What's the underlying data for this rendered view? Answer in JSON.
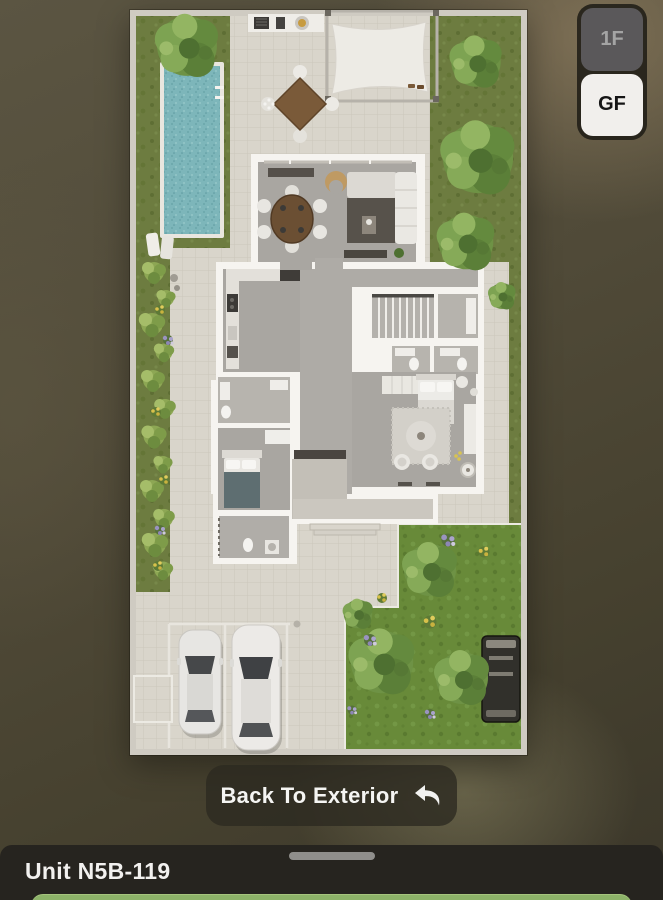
{
  "floor_selector": {
    "options": [
      {
        "label": "1F",
        "selected": false
      },
      {
        "label": "GF",
        "selected": true
      }
    ]
  },
  "back_button": {
    "label": "Back To Exterior",
    "icon": "back-arrow-icon"
  },
  "bottom_sheet": {
    "title": "Unit N5B-119"
  },
  "floorplan": {
    "floor_shown": "GF",
    "style": "top-down-3d-render",
    "visible_features": [
      "swimming-pool",
      "garden-trees",
      "canopy-pergola",
      "outdoor-dining",
      "bbq-counter",
      "living-dining-room",
      "kitchen",
      "stairs",
      "bathrooms",
      "master-bedroom",
      "bedroom",
      "laundry",
      "driveway-two-cars",
      "parking-stalls",
      "utility-vehicle"
    ]
  },
  "colors": {
    "cta_green": "#8db369",
    "selector_active_bg": "#f1efec",
    "selector_inactive_bg": "#5a585a",
    "sheet_bg": "#26241f",
    "pool": "#7db6ba"
  }
}
